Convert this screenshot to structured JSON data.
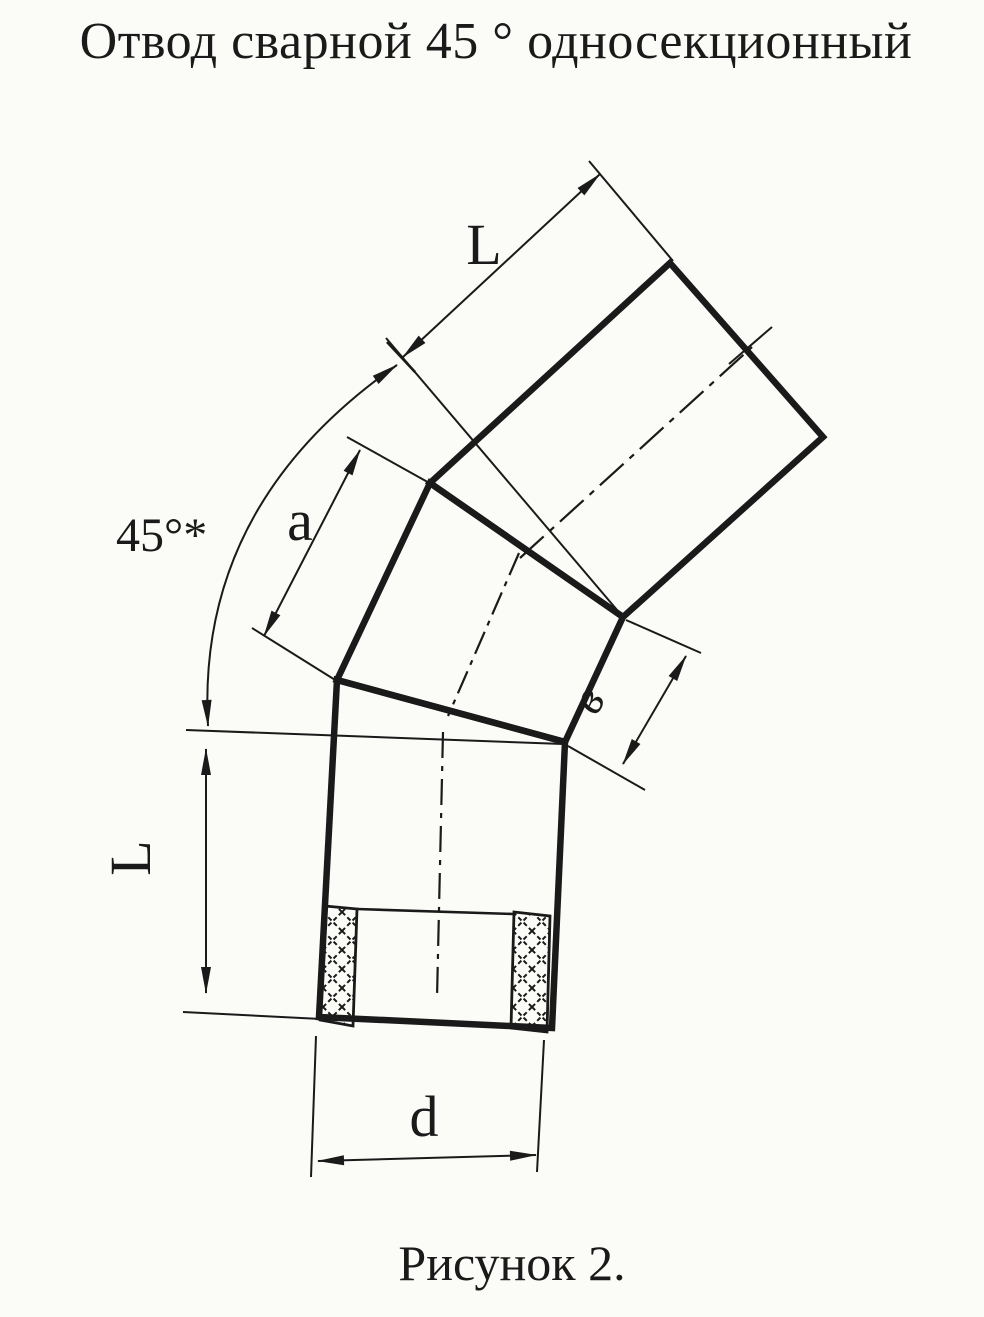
{
  "title": "Отвод сварной 45 ° односекционный",
  "figure_caption": "Рисунок 2.",
  "dimension_labels": {
    "angle": "45°*",
    "top_length": "L",
    "left_length": "L",
    "middle_segment": "a",
    "segment_width": "в",
    "diameter": "d"
  },
  "drawing_subject": "welded 45-degree single-section pipe elbow",
  "colors": {
    "ink": "#1a1a1a",
    "paper": "#fbfbf8"
  }
}
